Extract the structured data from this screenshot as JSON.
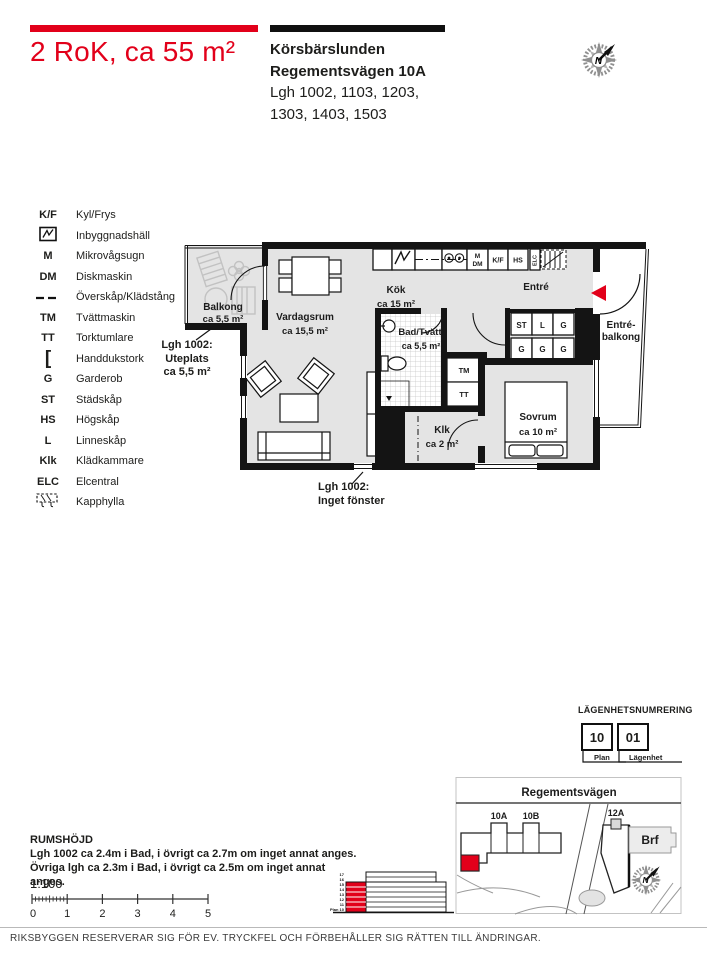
{
  "colors": {
    "accent": "#e2001a",
    "wall": "#141414",
    "room_fill": "#e4e4e4"
  },
  "header": {
    "title": "2 RoK, ca 55 m²",
    "project": "Körsbärslunden",
    "address": "Regementsvägen 10A",
    "apartments_line1": "Lgh 1002, 1103, 1203,",
    "apartments_line2": "1303, 1403, 1503"
  },
  "compass": {
    "letter": "N"
  },
  "legend": {
    "rows": [
      {
        "abbr": "K/F",
        "label": "Kyl/Frys"
      },
      {
        "abbr": "",
        "label": "Inbyggnadshäll"
      },
      {
        "abbr": "M",
        "label": "Mikrovågsugn"
      },
      {
        "abbr": "DM",
        "label": "Diskmaskin"
      },
      {
        "abbr": "",
        "label": "Överskåp/Klädstång"
      },
      {
        "abbr": "TM",
        "label": "Tvättmaskin"
      },
      {
        "abbr": "TT",
        "label": "Torktumlare"
      },
      {
        "abbr": "[",
        "label": "Handdukstork"
      },
      {
        "abbr": "G",
        "label": "Garderob"
      },
      {
        "abbr": "ST",
        "label": "Städskåp"
      },
      {
        "abbr": "HS",
        "label": "Högskåp"
      },
      {
        "abbr": "L",
        "label": "Linneskåp"
      },
      {
        "abbr": "Klk",
        "label": "Klädkammare"
      },
      {
        "abbr": "ELC",
        "label": "Elcentral"
      },
      {
        "abbr": "",
        "label": "Kapphylla"
      }
    ]
  },
  "floorplan": {
    "balkong": {
      "name": "Balkong",
      "area": "ca 5,5 m²"
    },
    "vardagsrum": {
      "name": "Vardagsrum",
      "area": "ca 15,5 m²"
    },
    "kok": {
      "name": "Kök",
      "area": "ca 15 m²"
    },
    "entre": {
      "name": "Entré"
    },
    "bad": {
      "name": "Bad/Tvätt",
      "area": "ca 5,5 m²"
    },
    "klk": {
      "name": "Klk",
      "area": "ca 2 m²"
    },
    "sovrum": {
      "name": "Sovrum",
      "area": "ca 10 m²"
    },
    "entre_balkong_line1": "Entré-",
    "entre_balkong_line2": "balkong",
    "tm": "TM",
    "tt": "TT",
    "appliance_m": "M",
    "appliance_dm": "DM",
    "appliance_kf": "K/F",
    "appliance_hs": "HS",
    "appliance_elc": "ELC",
    "closets_row1": [
      "ST",
      "L",
      "G"
    ],
    "closets_row2": [
      "G",
      "G",
      "G"
    ],
    "uteplats_note": {
      "l1": "Lgh 1002:",
      "l2": "Uteplats",
      "l3": "ca 5,5 m²"
    },
    "window_note": {
      "l1": "Lgh 1002:",
      "l2": "Inget fönster"
    }
  },
  "numbering": {
    "heading": "LÄGENHETSNUMRERING",
    "plan_value": "10",
    "plan_label": "Plan",
    "apt_value": "01",
    "apt_label": "Lägenhet"
  },
  "map": {
    "street": "Regementsvägen",
    "building_10a": "10A",
    "building_10b": "10B",
    "building_12a": "12A",
    "brf_label": "Brf"
  },
  "room_height": {
    "heading": "RUMSHÖJD",
    "line1": "Lgh 1002 ca 2.4m i Bad, i övrigt ca 2.7m om inget annat anges.",
    "line2": "Övriga lgh ca 2.3m i Bad, i övrigt ca 2.5m om inget annat anges.",
    "scale": "1:100",
    "ticks": [
      "0",
      "1",
      "2",
      "3",
      "4",
      "5"
    ]
  },
  "elevation": {
    "floors": [
      "17",
      "16",
      "15",
      "14",
      "13",
      "12",
      "11",
      "Plan 10"
    ]
  },
  "footer": {
    "disclaimer": "RIKSBYGGEN RESERVERAR SIG FÖR EV. TRYCKFEL OCH FÖRBEHÅLLER SIG RÄTTEN TILL ÄNDRINGAR."
  }
}
